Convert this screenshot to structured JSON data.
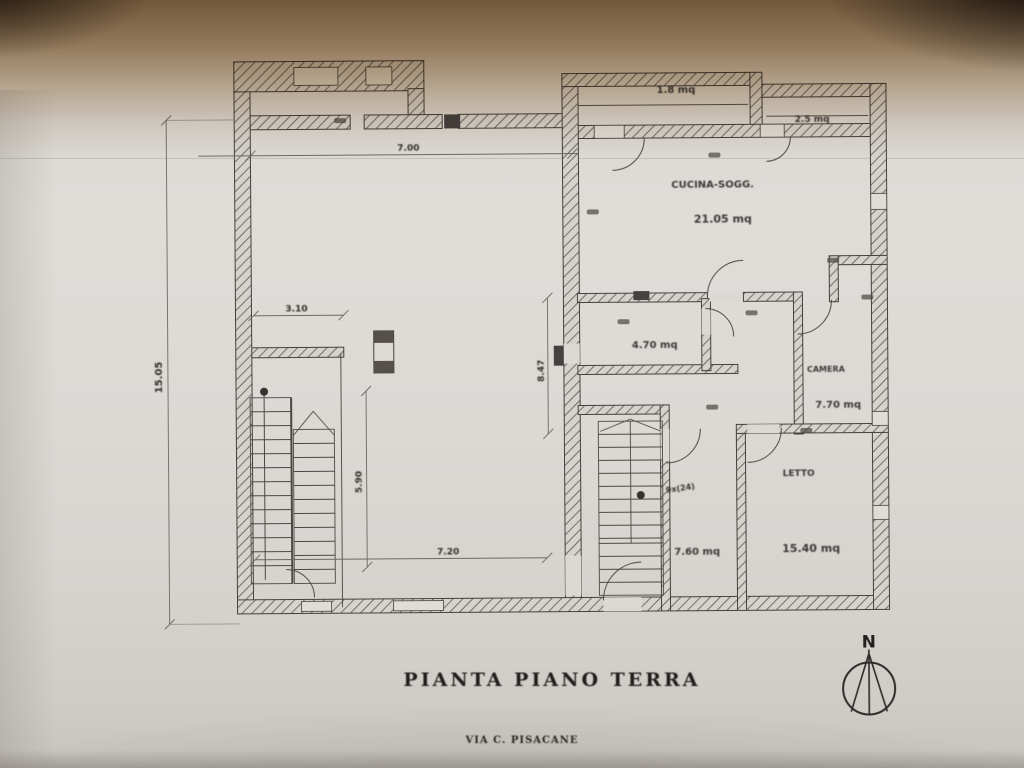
{
  "photo": {
    "title": "PIANTA PIANO TERRA",
    "subtitle": "VIA C. PISACANE",
    "compass": "N"
  },
  "plan": {
    "rooms": {
      "balcony_left": {
        "area": "1.8 mq"
      },
      "balcony_right": {
        "area": "2.5 mq"
      },
      "kitchen_living": {
        "label": "CUCINA-SOGG.",
        "area": "21.05 mq"
      },
      "bathroom": {
        "area": "4.70 mq"
      },
      "camera": {
        "label": "CAMERA",
        "area": "7.70 mq"
      },
      "letto": {
        "label": "LETTO",
        "area": "15.40 mq"
      },
      "hall": {
        "area": "7.60 mq"
      }
    },
    "dimensions": {
      "left_height": "15.05",
      "top_width": "7.00",
      "room_width": "3.10",
      "stair_run": "5.90",
      "bottom_width": "7.20",
      "mid_height": "8.47",
      "stair_note": "9x(24)"
    },
    "colors": {
      "ink": "#3a3632",
      "paper": "#dad7d3",
      "shadow_brown": "#8a6a48"
    }
  }
}
